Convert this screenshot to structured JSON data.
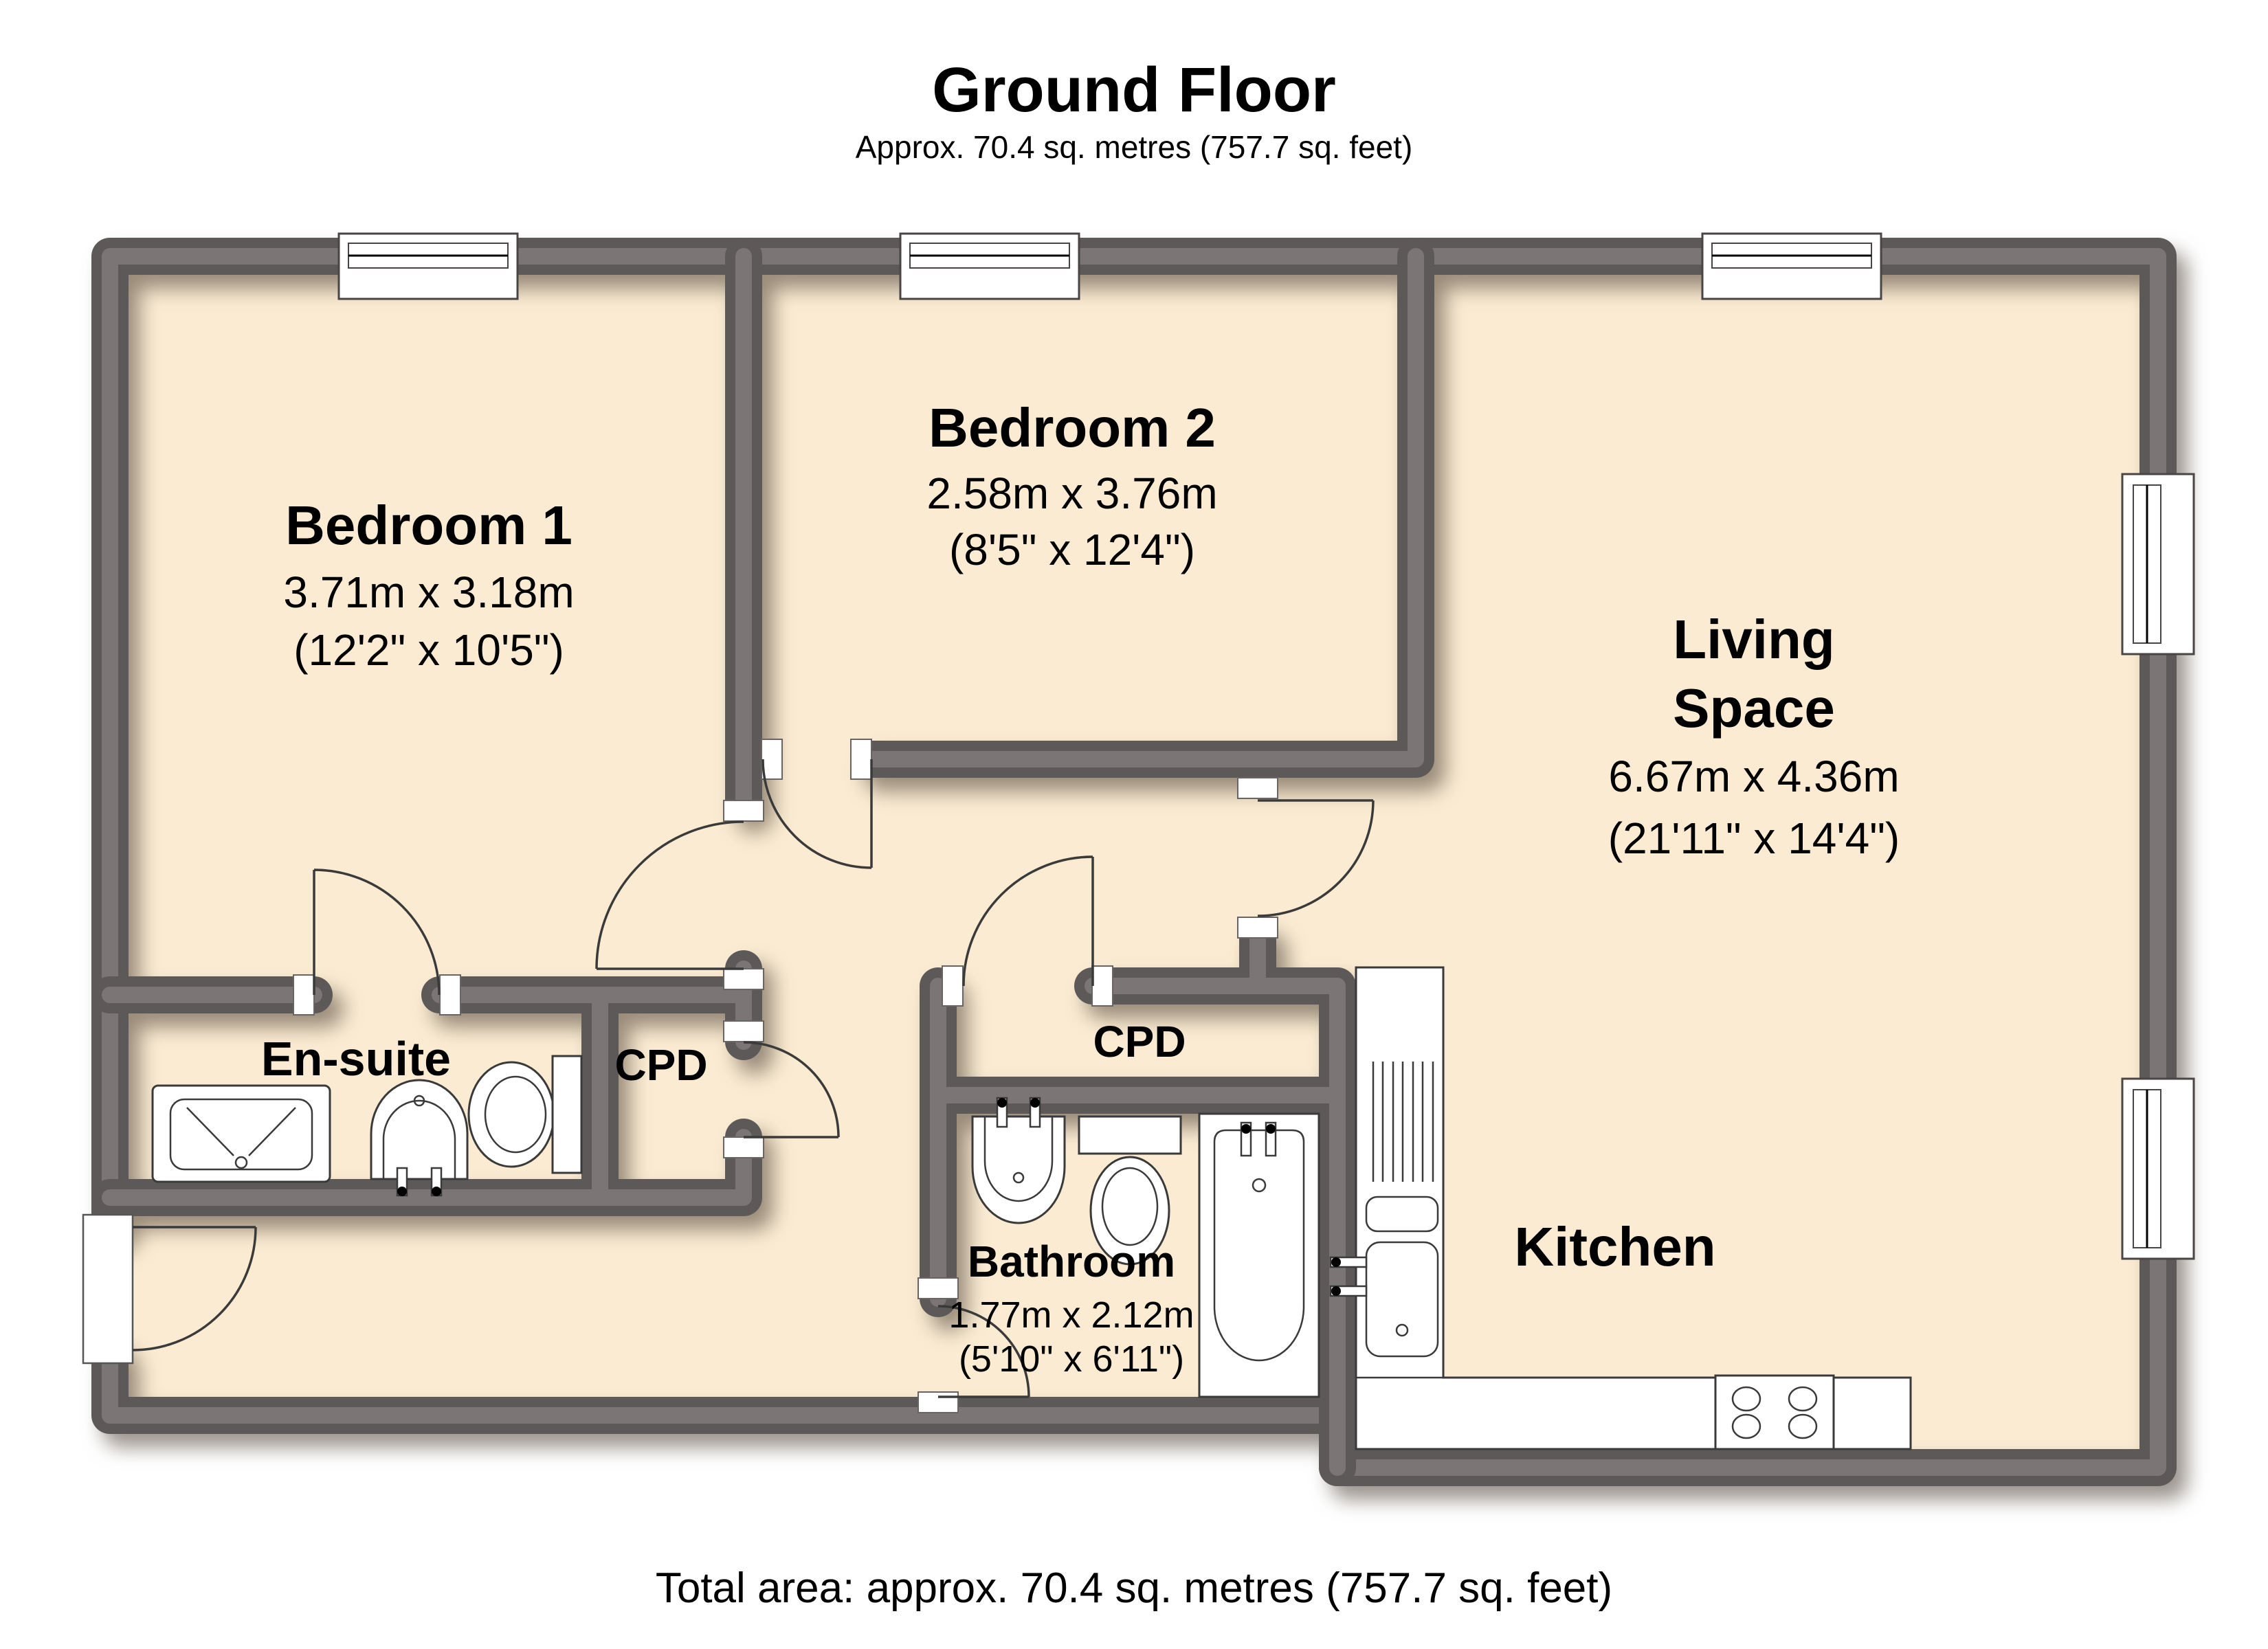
{
  "title": {
    "heading": "Ground Floor",
    "subtitle": "Approx. 70.4 sq. metres (757.7 sq. feet)"
  },
  "footer": {
    "total_area": "Total area: approx. 70.4 sq. metres (757.7 sq. feet)"
  },
  "rooms": {
    "bedroom1": {
      "name": "Bedroom 1",
      "metric": "3.71m x 3.18m",
      "imperial": "(12'2\" x 10'5\")"
    },
    "bedroom2": {
      "name": "Bedroom 2",
      "metric": "2.58m x 3.76m",
      "imperial": "(8'5\" x 12'4\")"
    },
    "living_space": {
      "name_line1": "Living",
      "name_line2": "Space",
      "metric": "6.67m x 4.36m",
      "imperial": "(21'11\" x 14'4\")"
    },
    "ensuite": {
      "name": "En-suite"
    },
    "cpd_left": {
      "name": "CPD"
    },
    "cpd_right": {
      "name": "CPD"
    },
    "bathroom": {
      "name": "Bathroom",
      "metric": "1.77m x 2.12m",
      "imperial": "(5'10\" x 6'11\")"
    },
    "kitchen": {
      "name": "Kitchen"
    }
  },
  "colors": {
    "floor": "#FAEBD2",
    "wall_edge": "#5E5959",
    "wall_core": "#7B7575",
    "line": "#3A3A3A",
    "background": "#FFFFFF"
  }
}
